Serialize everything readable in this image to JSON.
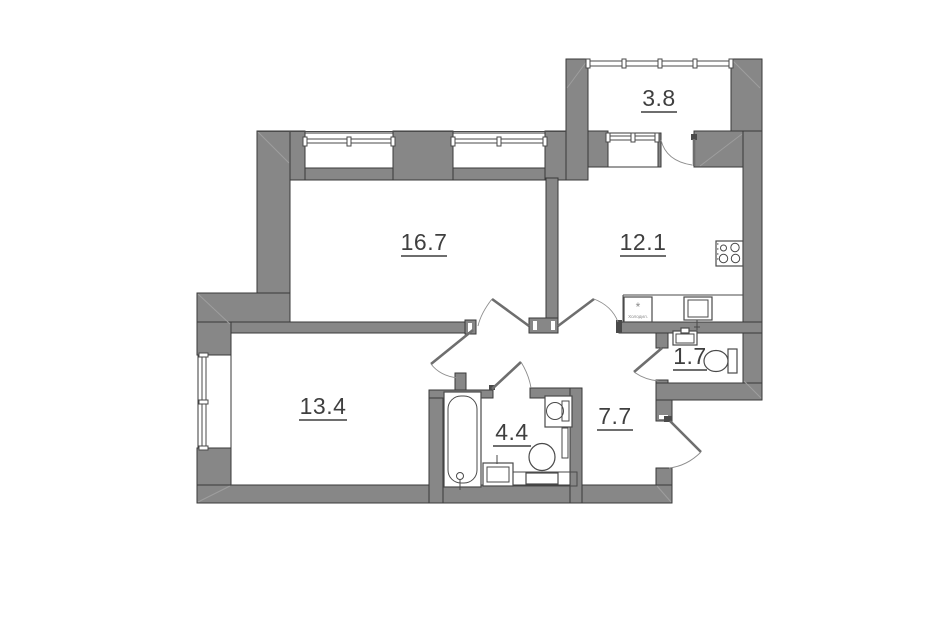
{
  "floorplan": {
    "type": "apartment-floor-plan",
    "colors": {
      "wall": "#878787",
      "edge": "#3a3a3a",
      "glazing": "#4a4a4a",
      "fixture_line": "#4a4a4a",
      "door_leaf": "#6e6e6e",
      "arc_line": "#8d8d8d",
      "label": "#3f3f3f"
    },
    "rooms": [
      {
        "id": "balcony",
        "area": "3.8"
      },
      {
        "id": "living-room",
        "area": "16.7"
      },
      {
        "id": "kitchen",
        "area": "12.1"
      },
      {
        "id": "wc",
        "area": "1.7"
      },
      {
        "id": "bedroom",
        "area": "13.4"
      },
      {
        "id": "bathroom",
        "area": "4.4"
      },
      {
        "id": "hallway",
        "area": "7.7"
      }
    ],
    "fixtures": {
      "fridge_symbol": "*",
      "fridge_label": "Холодил.",
      "icons": [
        "stove-icon",
        "fridge-icon",
        "kitchen-sink-icon",
        "wc-sink-icon",
        "toilet-icon",
        "bathtub-icon",
        "washing-machine-icon",
        "bathroom-sink-icon",
        "toilet-icon",
        "duct-icon"
      ]
    }
  }
}
